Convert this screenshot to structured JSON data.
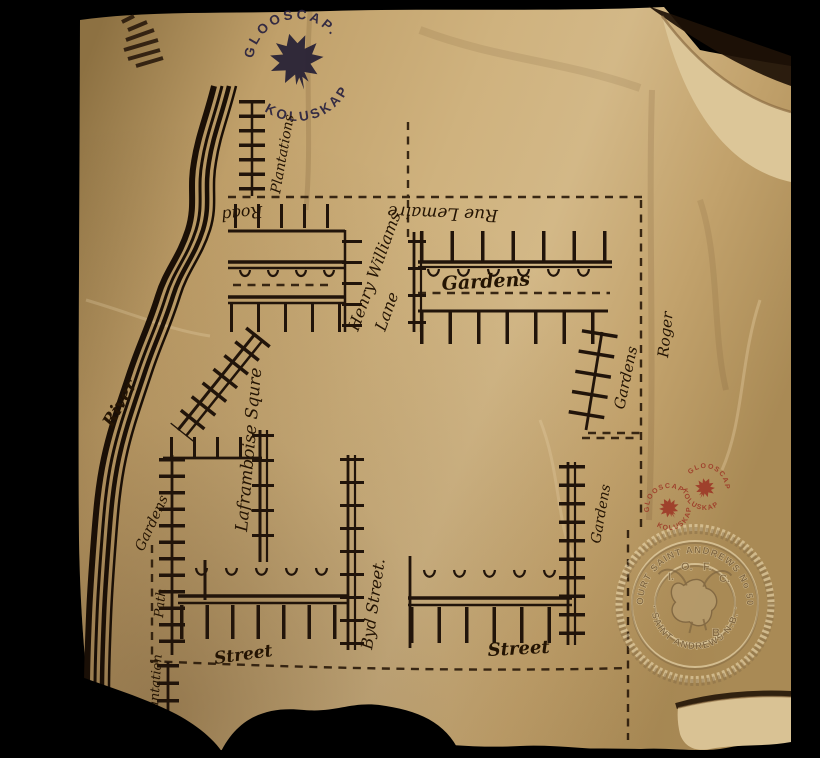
{
  "photo": {
    "background_color": "#000000",
    "paper_color": "#c9ab79",
    "ink_color": "#21140a",
    "stamp_navy_color": "#2a2340",
    "stamp_red_color": "#9c3424"
  },
  "stamps": {
    "glooscap_large": {
      "arc_top": "GLOOSCAP.",
      "arc_bottom": "KOLUSKAP",
      "icon": "maple-leaf-icon"
    },
    "glooscap_red_left": {
      "arc_top": "GLOOSCAP",
      "arc_bottom": "KOLUSKAP",
      "icon": "maple-leaf-icon"
    },
    "glooscap_red_right": {
      "arc_top": "GLOOSCAP",
      "arc_bottom": "KOLUSKAP",
      "icon": "maple-leaf-icon"
    }
  },
  "labels": {
    "river": "River",
    "plantations": "Plantations",
    "road": "Road",
    "rue_lemaire": "Rue Lemaire",
    "henry_williams": "Henry Williams",
    "lane": "Lane",
    "gardens_top": "Gardens",
    "gardens_right": "Gardens",
    "roger": "Roger",
    "laframboise_square": "Laframboise Squre",
    "gardens_river": "Gardens",
    "path": "Path",
    "byd_street": "Byd Street.",
    "street_left": "Street",
    "street_right": "Street",
    "gardens_bottom_right": "Gardens",
    "plantation_bottom": "Plantation"
  },
  "seal": {
    "arc_top": "COURT SAINT ANDREWS No 508",
    "arc_bottom": "· SAINT ANDREWS N.B. ·",
    "icon": "moose-head-icon",
    "inner_letters": {
      "i": "I.",
      "o": "O.",
      "f": "F.",
      "c": "C.",
      "b": "B."
    }
  }
}
